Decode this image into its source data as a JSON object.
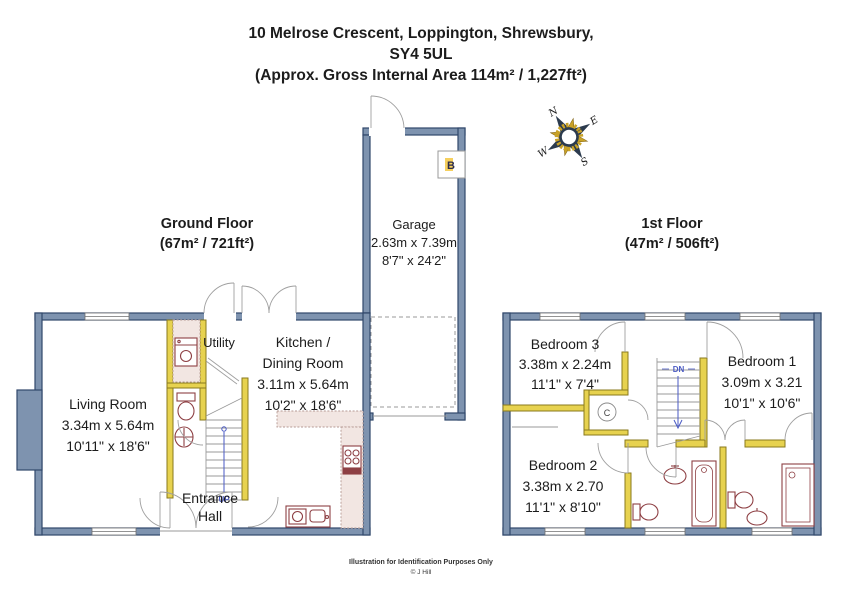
{
  "title": {
    "line1": "10 Melrose Crescent, Loppington, Shrewsbury,",
    "line2": "SY4 5UL",
    "line3": "(Approx. Gross Internal Area 114m² / 1,227ft²)"
  },
  "floors": {
    "ground": {
      "name": "Ground Floor",
      "area": "(67m² / 721ft²)"
    },
    "first": {
      "name": "1st Floor",
      "area": "(47m² / 506ft²)"
    }
  },
  "rooms": {
    "garage": {
      "name": "Garage",
      "metric": "2.63m x 7.39m",
      "imperial": "8'7\" x 24'2\""
    },
    "living": {
      "name": "Living Room",
      "metric": "3.34m x 5.64m",
      "imperial": "10'11\" x 18'6\""
    },
    "kitchen": {
      "name1": "Kitchen /",
      "name2": "Dining Room",
      "metric": "3.11m x 5.64m",
      "imperial": "10'2\" x 18'6\""
    },
    "utility": {
      "name": "Utility"
    },
    "hall": {
      "line1": "Entrance",
      "line2": "Hall"
    },
    "bedroom1": {
      "name": "Bedroom 1",
      "metric": "3.09m x 3.21",
      "imperial": "10'1\" x 10'6\""
    },
    "bedroom2": {
      "name": "Bedroom 2",
      "metric": "3.38m x 2.70",
      "imperial": "11'1\" x 8'10\""
    },
    "bedroom3": {
      "name": "Bedroom 3",
      "metric": "3.38m x 2.24m",
      "imperial": "11'1\" x 7'4\""
    }
  },
  "labels": {
    "up": "UP",
    "dn": "DN",
    "garage_ref": "B",
    "cupboard": "C"
  },
  "compass": {
    "n": "N",
    "e": "E",
    "s": "S",
    "w": "W"
  },
  "footer": {
    "line1": "Illustration for Identification Purposes Only",
    "line2": "© J Hill"
  },
  "colors": {
    "wall": "#7e93af",
    "wall_border": "#31486b",
    "partition": "#e7d24f",
    "fixture": "#8e4044",
    "stair_text": "#4a5ac4",
    "compass_gold": "#c9a227"
  }
}
